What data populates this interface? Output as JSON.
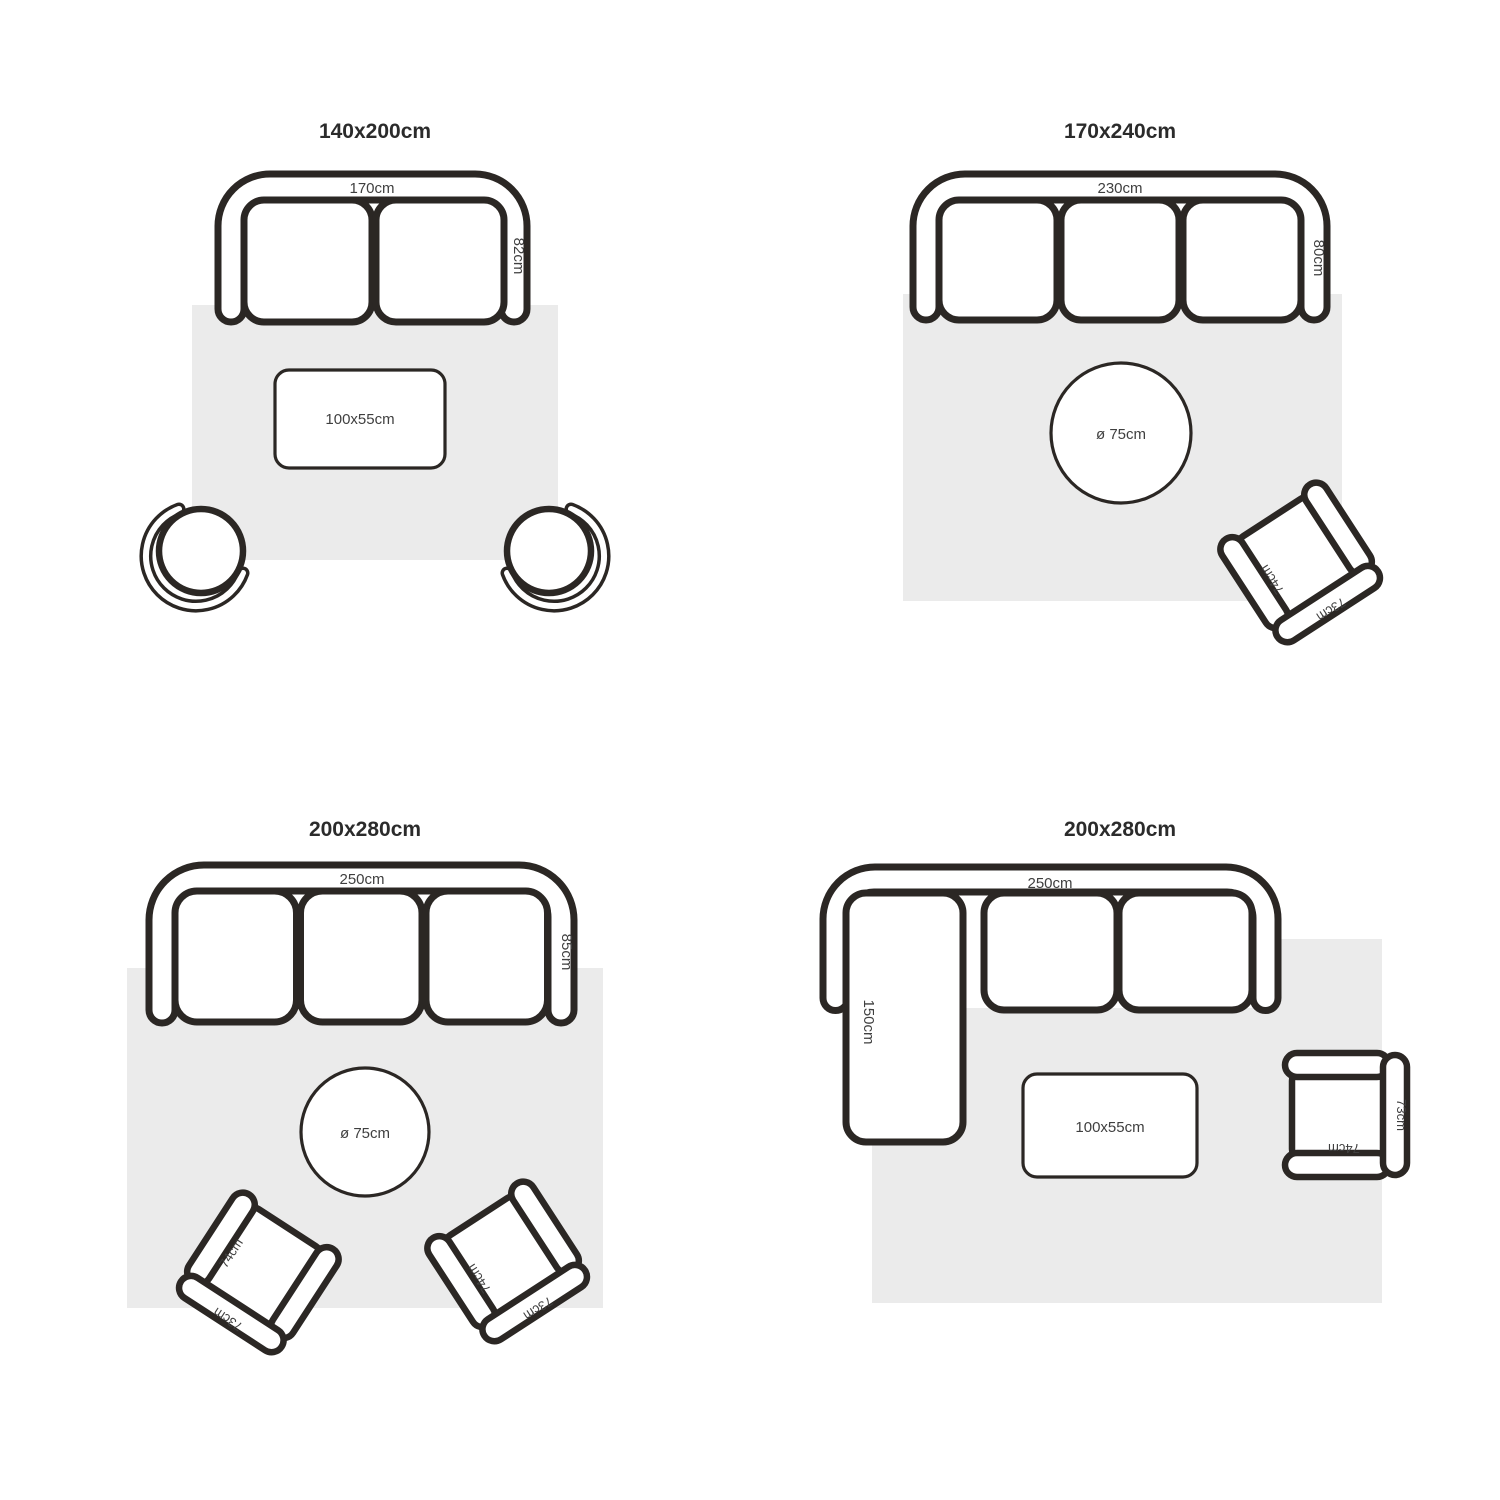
{
  "colors": {
    "background": "#ffffff",
    "line": "#2b2724",
    "rug": "#ebebeb",
    "label_text": "#3f3f3f",
    "title_text": "#2b2b2b"
  },
  "shared": {
    "armchair": {
      "width_label": "74cm",
      "depth_label": "73cm"
    }
  },
  "panels": [
    {
      "title": "140x200cm",
      "sofa": {
        "seats": 2,
        "width_label": "170cm",
        "depth_label": "82cm"
      },
      "coffee_table": {
        "label": "100x55cm"
      },
      "stools": 2
    },
    {
      "title": "170x240cm",
      "sofa": {
        "seats": 3,
        "width_label": "230cm",
        "depth_label": "80cm"
      },
      "round_table": {
        "label": "ø 75cm"
      },
      "armchairs": 1
    },
    {
      "title": "200x280cm",
      "sofa": {
        "seats": 3,
        "width_label": "250cm",
        "depth_label": "85cm"
      },
      "round_table": {
        "label": "ø 75cm"
      },
      "armchairs": 2
    },
    {
      "title": "200x280cm",
      "sofa": {
        "seats": 3,
        "type": "corner",
        "width_label": "250cm",
        "chaise_label": "150cm"
      },
      "coffee_table": {
        "label": "100x55cm"
      },
      "armchairs": 1
    }
  ]
}
